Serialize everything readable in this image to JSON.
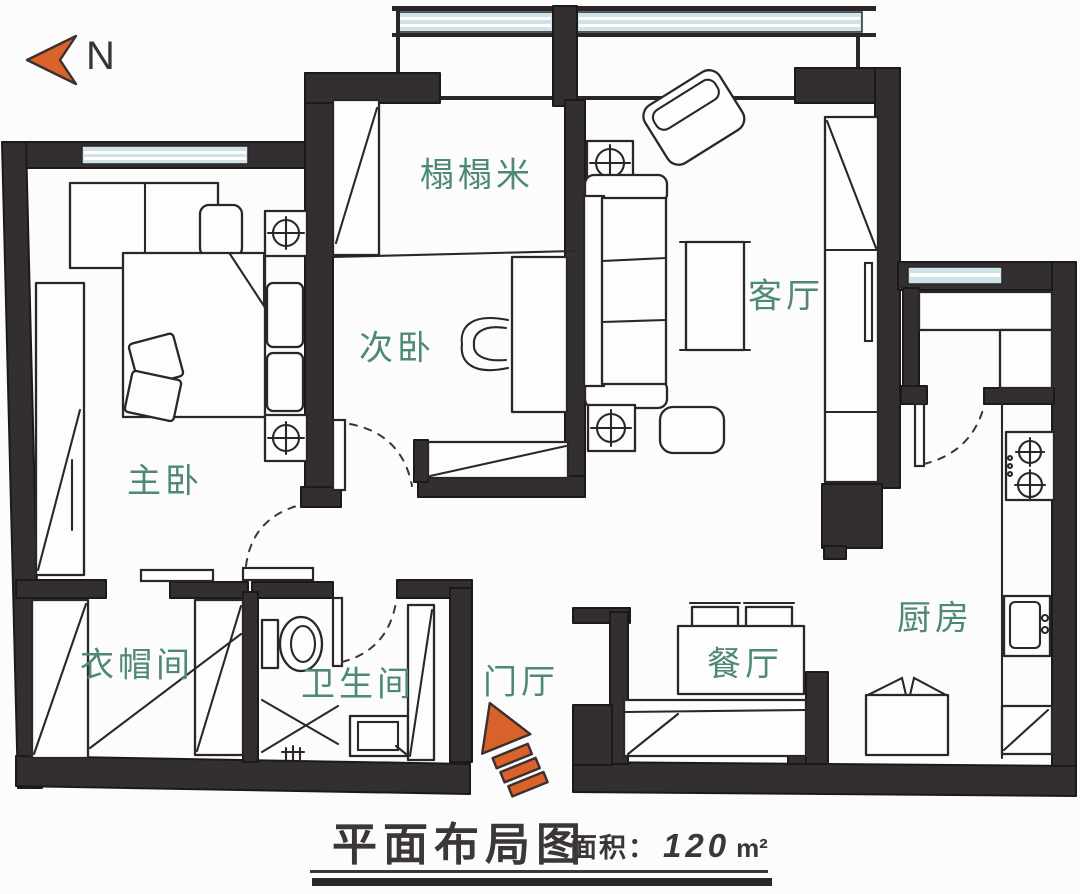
{
  "meta": {
    "width": 1080,
    "height": 894,
    "drawing_style": "hand-drawn floor plan"
  },
  "compass": {
    "label": "N",
    "icon": "north-arrow-left-chevron"
  },
  "rooms": [
    {
      "name": "tatami",
      "label": "榻榻米"
    },
    {
      "name": "second-bedroom",
      "label": "次卧"
    },
    {
      "name": "living-room",
      "label": "客厅"
    },
    {
      "name": "master-bedroom",
      "label": "主卧"
    },
    {
      "name": "cloakroom",
      "label": "衣帽间"
    },
    {
      "name": "bathroom",
      "label": "卫生间"
    },
    {
      "name": "entrance-hall",
      "label": "门厅"
    },
    {
      "name": "dining-room",
      "label": "餐厅"
    },
    {
      "name": "kitchen",
      "label": "厨房"
    }
  ],
  "title": {
    "main": "平面布局图",
    "area_label": "面积：",
    "area_value": "120",
    "area_unit": "m²"
  },
  "colors": {
    "wall": "#332f30",
    "window_glass": "#cfe2e8",
    "room_label": "#4e8878",
    "accent_orange": "#d9622b",
    "title_text": "#3b3738",
    "background": "#fcfcfc"
  }
}
